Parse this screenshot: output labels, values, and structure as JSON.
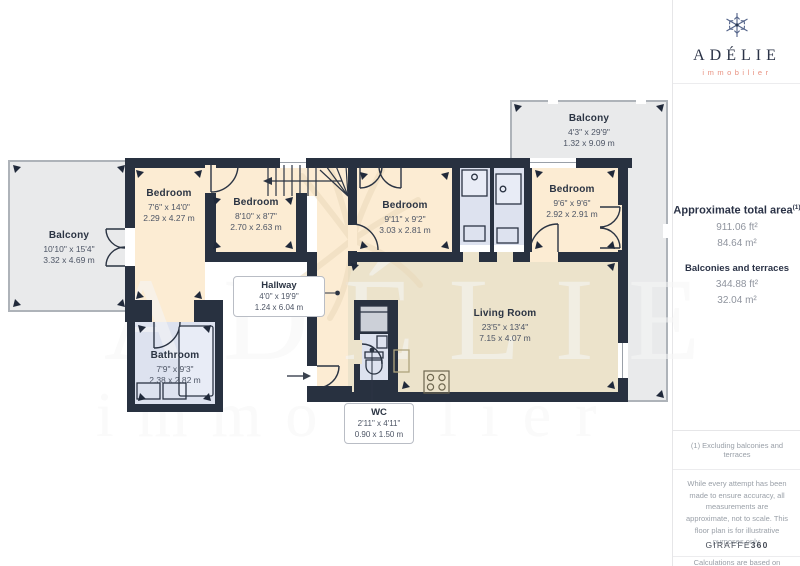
{
  "logo": {
    "brand": "ADÉLIE",
    "sub": "immobilier"
  },
  "sidebar": {
    "total_area_label": "Approximate total area",
    "total_area_sup": "(1)",
    "total_area_ft": "911.06 ft²",
    "total_area_m": "84.64 m²",
    "balconies_label": "Balconies and terraces",
    "balconies_ft": "344.88 ft²",
    "balconies_m": "32.04 m²",
    "footnote": "(1) Excluding balconies and terraces",
    "disclaimer": "While every attempt has been made to ensure accuracy, all measurements are approximate, not to scale. This floor plan is for illustrative purposes only.",
    "standard": "Calculations are based on RICS IPMS 3C standard.",
    "brand_word": "GIRAFFE",
    "brand_num": "360"
  },
  "watermark": {
    "line1": "ADÉLIE",
    "line2": "immobilier"
  },
  "rooms": {
    "balcony_left": {
      "name": "Balcony",
      "ft": "10'10\" x 15'4\"",
      "m": "3.32 x 4.69 m"
    },
    "balcony_top": {
      "name": "Balcony",
      "ft": "4'3\" x 29'9\"",
      "m": "1.32 x 9.09 m"
    },
    "bedroom1": {
      "name": "Bedroom",
      "ft": "7'6\" x 14'0\"",
      "m": "2.29 x 4.27 m"
    },
    "bedroom2": {
      "name": "Bedroom",
      "ft": "8'10\" x 8'7\"",
      "m": "2.70 x 2.63 m"
    },
    "bedroom3": {
      "name": "Bedroom",
      "ft": "9'11\" x 9'2\"",
      "m": "3.03 x 2.81 m"
    },
    "bedroom4": {
      "name": "Bedroom",
      "ft": "9'6\" x 9'6\"",
      "m": "2.92 x 2.91 m"
    },
    "hallway": {
      "name": "Hallway",
      "ft": "4'0\" x 19'9\"",
      "m": "1.24 x 6.04 m"
    },
    "bathroom": {
      "name": "Bathroom",
      "ft": "7'9\" x 9'3\"",
      "m": "2.38 x 2.82 m"
    },
    "wc": {
      "name": "WC",
      "ft": "2'11\" x 4'11\"",
      "m": "0.90 x 1.50 m"
    },
    "living": {
      "name": "Living Room",
      "ft": "23'5\" x 13'4\"",
      "m": "7.15 x 4.07 m"
    }
  },
  "colors": {
    "wall": "#283140",
    "bedroom_floor": "#fcecd3",
    "living_floor": "#ece3cb",
    "wet_floor": "#dde2ef",
    "balcony_floor": "#e9eaeb",
    "accent_salmon": "#e89180",
    "navy": "#2b3347"
  }
}
